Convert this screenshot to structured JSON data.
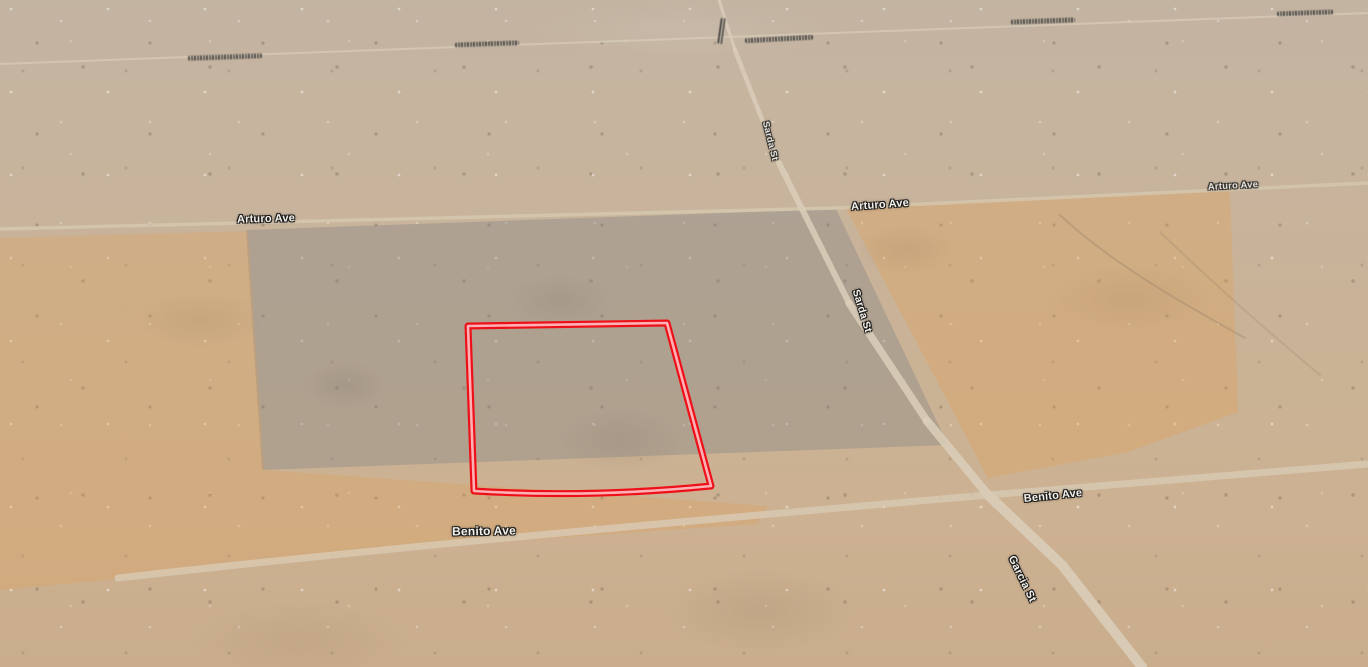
{
  "map": {
    "parcel": {
      "color": "#ee1018",
      "inner_color": "#ffb0b5"
    },
    "road_color": "#dbcfba",
    "labels": [
      {
        "name": "arturo-ave-left",
        "text": "Arturo Ave"
      },
      {
        "name": "sarda-st-upper",
        "text": "Sarda St"
      },
      {
        "name": "arturo-ave-mid",
        "text": "Arturo Ave"
      },
      {
        "name": "arturo-ave-right",
        "text": "Arturo Ave"
      },
      {
        "name": "sarda-st-lower",
        "text": "Sarda St"
      },
      {
        "name": "benito-ave-center",
        "text": "Benito Ave"
      },
      {
        "name": "benito-ave-right",
        "text": "Benito Ave"
      },
      {
        "name": "garcia-st",
        "text": "Garcia St"
      }
    ]
  }
}
